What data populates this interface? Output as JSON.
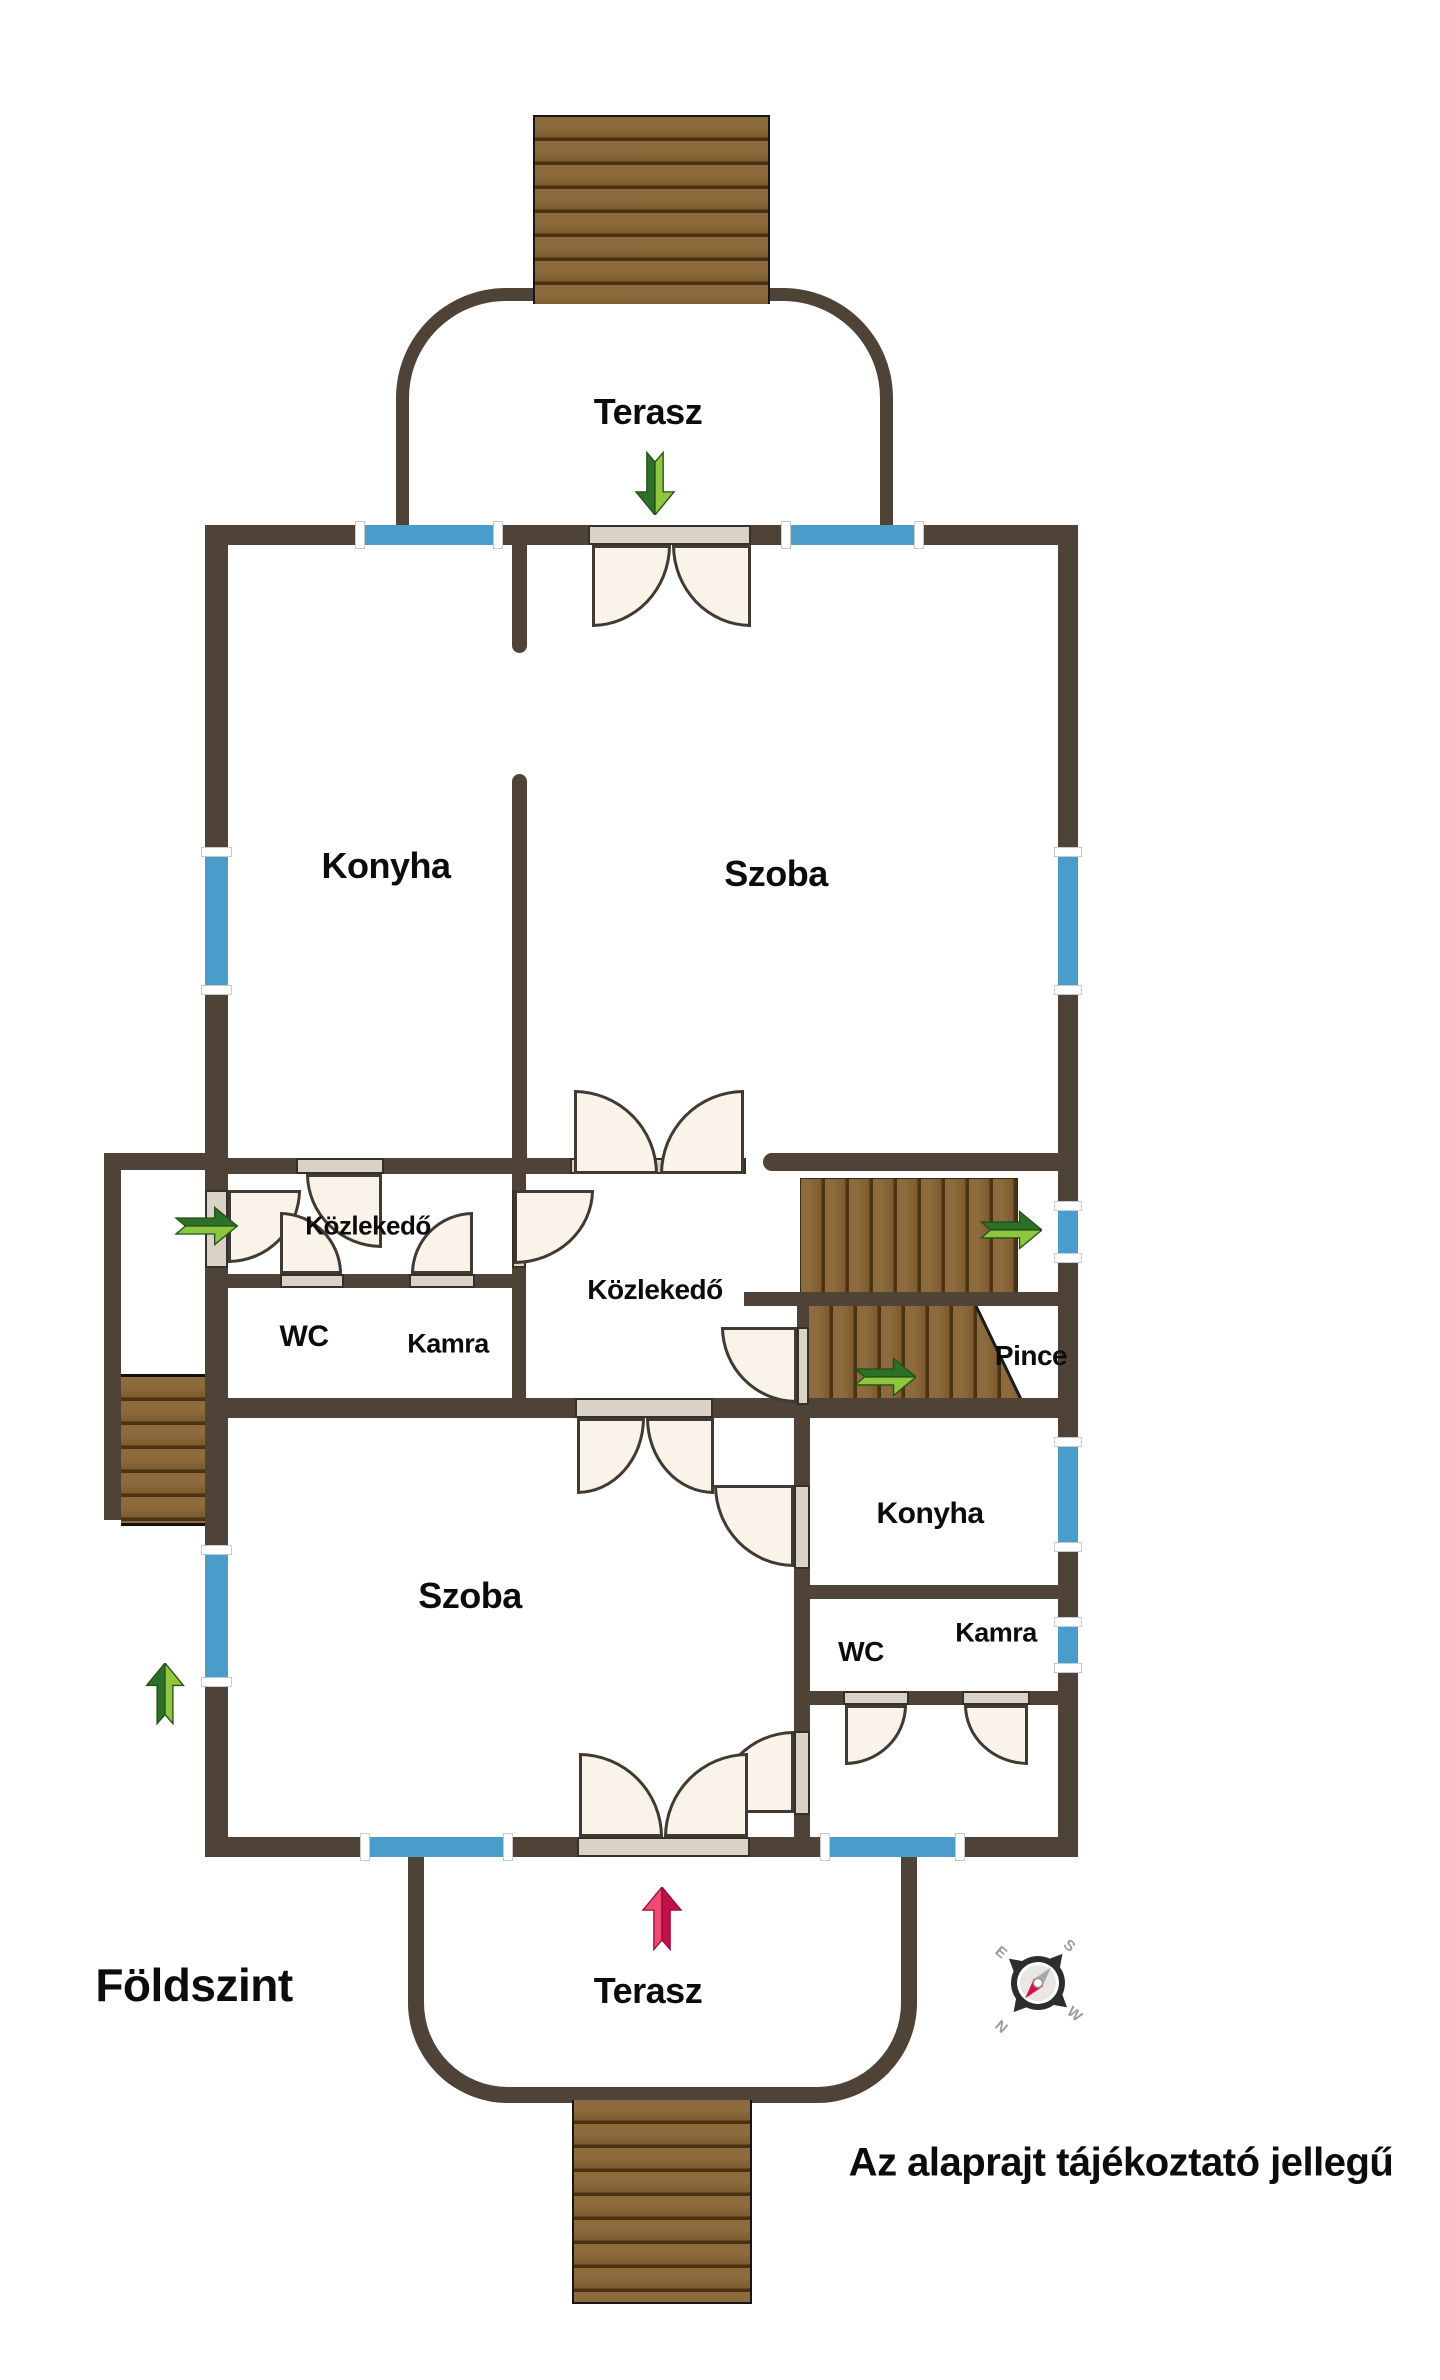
{
  "title": {
    "floor_label": "Földszint",
    "disclaimer": "Az alaprajt tájékoztató jellegű"
  },
  "rooms": {
    "terasz_top": "Terasz",
    "konyha_upper": "Konyha",
    "szoba_upper": "Szoba",
    "kozlekedo_upper": "Közlekedő",
    "wc_upper": "WC",
    "kamra_upper": "Kamra",
    "kozlekedo_main": "Közlekedő",
    "pince": "Pince",
    "szoba_lower": "Szoba",
    "konyha_lower": "Konyha",
    "wc_lower": "WC",
    "kamra_lower": "Kamra",
    "terasz_bottom": "Terasz"
  },
  "compass": {
    "n": "N",
    "s": "S",
    "e": "E",
    "w": "W"
  },
  "colors": {
    "wall": "#4f4236",
    "blue": "#4a9dcb",
    "wood": "#8d6b3c",
    "wood2": "#7d5c30",
    "wood-dark": "#4a3314",
    "door-fill": "#faf3ea",
    "door-line": "#403a33",
    "threshold": "#d9d2c6",
    "green-light": "#8dc63f",
    "green-dark": "#2d7128",
    "green-edge": "#235018",
    "pink-light": "#ee4b72",
    "pink-dark": "#c4104a",
    "pink-edge": "#9c0c3a",
    "needle-gray": "#a8a8a8",
    "needle-red": "#cf1446"
  }
}
